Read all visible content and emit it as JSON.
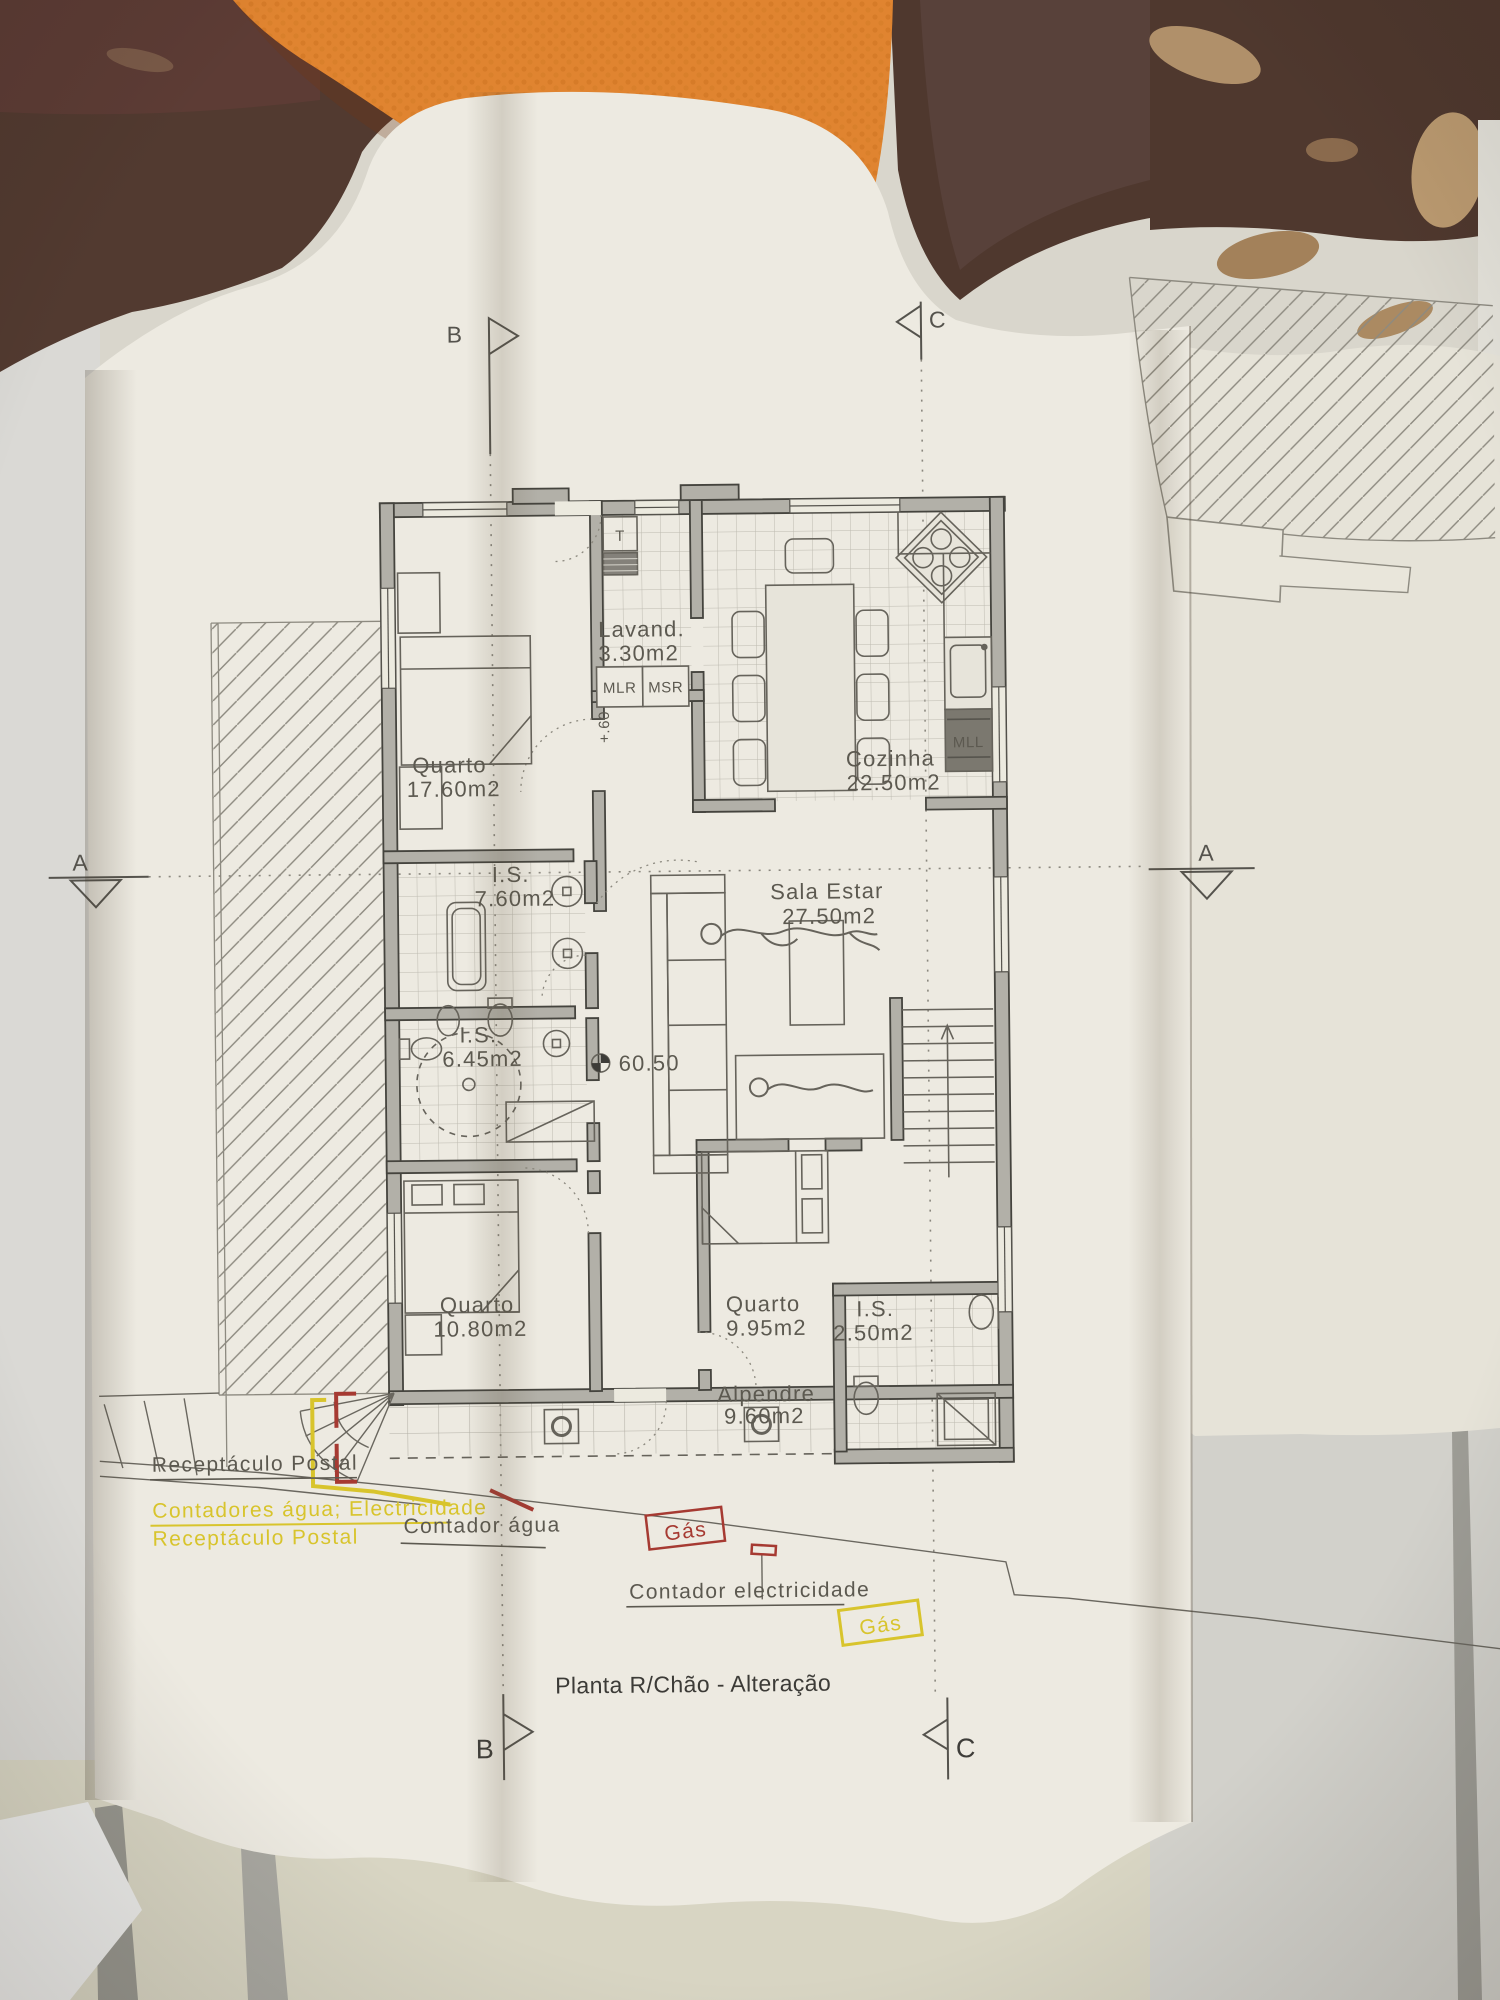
{
  "drawing_title": "Planta R/Chão - Alteração",
  "rooms": [
    {
      "name": "Quarto",
      "area": "17.60m2"
    },
    {
      "name": "Lavand.",
      "area": "3.30m2"
    },
    {
      "name": "Cozinha",
      "area": "22.50m2"
    },
    {
      "name": "I.S.",
      "area": "7.60m2"
    },
    {
      "name": "Sala  Estar",
      "area": "27.50m2"
    },
    {
      "name": "I.S.",
      "area": "6.45m2"
    },
    {
      "name": "Quarto",
      "area": "10.80m2"
    },
    {
      "name": "Quarto",
      "area": "9.95m2"
    },
    {
      "name": "I.S.",
      "area": "2.50m2"
    },
    {
      "name": "Alpendre",
      "area": "9.60m2"
    }
  ],
  "appliance_labels": {
    "water_heater": "T",
    "washing_machine": "MLR",
    "dryer": "MSR",
    "dishwasher": "MLL"
  },
  "levels": {
    "floor_level": "60.50",
    "step_level": "+.60"
  },
  "section_markers": {
    "a": "A",
    "b": "B",
    "c": "C"
  },
  "annotations": {
    "receptaculo_postal": "Receptáculo Postal",
    "contadores_agua_electricidade": "Contadores água; Electricidade",
    "receptaculo_postal_2": "Receptáculo Postal",
    "contador_agua": "Contador água",
    "gas_1": "Gás",
    "contador_electricidade": "Contador electricidade",
    "gas_2": "Gás"
  },
  "colors": {
    "annotation_yellow": "#d8c42c",
    "annotation_red": "#a63a32",
    "drawing_line": "#6a675f",
    "wall_fill": "#b2b0a8",
    "background_brown": "#4f382e",
    "towel_orange": "#e08430",
    "paper": "#edeae1"
  }
}
